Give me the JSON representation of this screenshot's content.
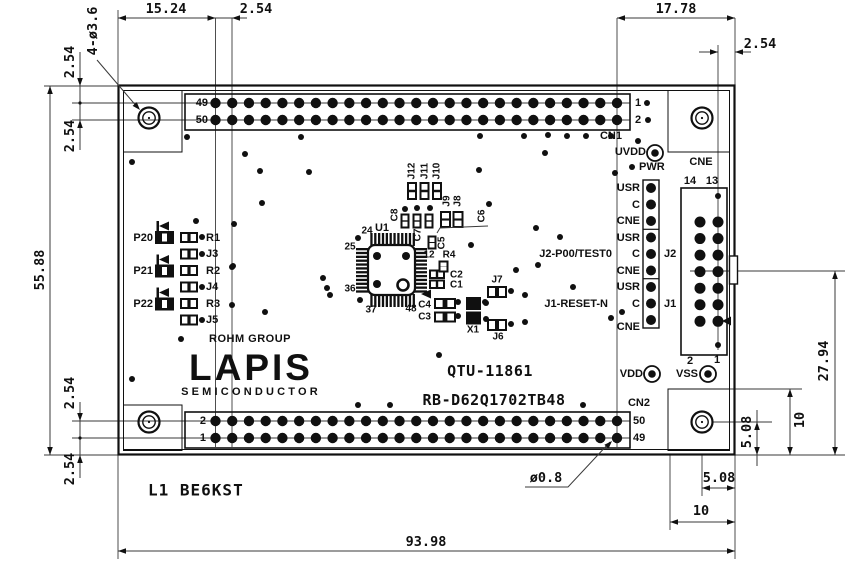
{
  "title_block": {
    "board_name": "QTU-11861",
    "board_code": "RB-D62Q1702TB48",
    "note": "L1 BE6KST"
  },
  "logo": {
    "group": "ROHM GROUP",
    "brand": "LAPIS",
    "sub": "SEMICONDUCTOR"
  },
  "dimensions": {
    "top_left_width": "15.24",
    "top_pin_pitch": "2.54",
    "top_right_width": "17.78",
    "right_edge_pitch": "2.54",
    "left_top_offset": "2.54",
    "mount_hole_note": "4-ø3.6",
    "left_row_pitch": "2.54",
    "board_height": "55.88",
    "bottom_row_pitch": "2.54",
    "bottom_edge_offset": "2.54",
    "board_width": "93.98",
    "cne_to_bottom": "27.94",
    "corner_box_height": "10",
    "hole_to_bottom": "5.08",
    "hole_to_edge": "5.08",
    "corner_box_width": "10",
    "pin_hole_dia": "ø0.8"
  },
  "connectors": {
    "cn1": {
      "label": "CN1",
      "pin_left_top": "49",
      "pin_left_bottom": "50",
      "pin_right_top": "1",
      "pin_right_bottom": "2",
      "columns": 25,
      "rows": 2
    },
    "cn2": {
      "label": "CN2",
      "pin_left_top": "2",
      "pin_left_bottom": "1",
      "pin_right_top": "50",
      "pin_right_bottom": "49",
      "columns": 25,
      "rows": 2
    },
    "cne": {
      "label": "CNE",
      "pin_top_left": "14",
      "pin_top_right": "13",
      "pin_bottom_left": "2",
      "pin_bottom_right": "1",
      "columns": 2,
      "rows": 7
    },
    "headers": {
      "j2": "J2",
      "j1": "J1",
      "pins": 9,
      "pin_labels": [
        "USR",
        "C",
        "CNE",
        "USR",
        "C",
        "CNE",
        "USR",
        "C",
        "CNE"
      ]
    }
  },
  "test_points": {
    "uvdd": "UVDD",
    "pwr": "PWR",
    "vdd": "VDD",
    "vss": "VSS"
  },
  "signals": {
    "j2_p00": "J2-P00/TEST0",
    "j1_reset": "J1-RESET-N"
  },
  "ic": {
    "ref": "U1",
    "pin_numbers": {
      "p24": "24",
      "p25": "25",
      "p36": "36",
      "p37": "37",
      "p48": "48",
      "p12": "12"
    }
  },
  "components": {
    "p20": "P20",
    "p21": "P21",
    "p22": "P22",
    "r1": "R1",
    "r2": "R2",
    "r3": "R3",
    "r4": "R4",
    "j3": "J3",
    "j4": "J4",
    "j5": "J5",
    "j6": "J6",
    "j7": "J7",
    "j8": "J8",
    "j9": "J9",
    "j10": "J10",
    "j11": "J11",
    "j12": "J12",
    "c1": "C1",
    "c2": "C2",
    "c3": "C3",
    "c4": "C4",
    "c5": "C5",
    "c6": "C6",
    "c7": "C7",
    "c8": "C8",
    "x1": "X1"
  },
  "colors": {
    "line": "#101010",
    "dim_line": "#3a3a3a",
    "background": "#ffffff"
  },
  "geometry": {
    "vias": [
      [
        187,
        137
      ],
      [
        301,
        137
      ],
      [
        480,
        136
      ],
      [
        524,
        136
      ],
      [
        548,
        135
      ],
      [
        567,
        136
      ],
      [
        586,
        136
      ],
      [
        611,
        136
      ],
      [
        638,
        141
      ],
      [
        647,
        103
      ],
      [
        648,
        120
      ],
      [
        132,
        162
      ],
      [
        245,
        154
      ],
      [
        260,
        171
      ],
      [
        309,
        172
      ],
      [
        479,
        170
      ],
      [
        545,
        153
      ],
      [
        615,
        173
      ],
      [
        196,
        221
      ],
      [
        234,
        224
      ],
      [
        262,
        203
      ],
      [
        405,
        209
      ],
      [
        417,
        208
      ],
      [
        430,
        208
      ],
      [
        489,
        204
      ],
      [
        536,
        228
      ],
      [
        560,
        237
      ],
      [
        358,
        238
      ],
      [
        232,
        267
      ],
      [
        471,
        245
      ],
      [
        516,
        270
      ],
      [
        538,
        265
      ],
      [
        323,
        278
      ],
      [
        327,
        288
      ],
      [
        330,
        295
      ],
      [
        360,
        300
      ],
      [
        265,
        312
      ],
      [
        485,
        302
      ],
      [
        525,
        295
      ],
      [
        573,
        287
      ],
      [
        611,
        318
      ],
      [
        525,
        322
      ],
      [
        511,
        291
      ],
      [
        511,
        324
      ],
      [
        486,
        303
      ],
      [
        486,
        319
      ],
      [
        202,
        237
      ],
      [
        202,
        254
      ],
      [
        202,
        287
      ],
      [
        202,
        320
      ],
      [
        233,
        266
      ],
      [
        232,
        305
      ],
      [
        181,
        339
      ],
      [
        132,
        379
      ],
      [
        439,
        355
      ],
      [
        358,
        405
      ],
      [
        390,
        405
      ],
      [
        583,
        405
      ],
      [
        622,
        312
      ],
      [
        458,
        302
      ],
      [
        458,
        316
      ],
      [
        632,
        167
      ],
      [
        718,
        196
      ],
      [
        718,
        345
      ]
    ]
  }
}
